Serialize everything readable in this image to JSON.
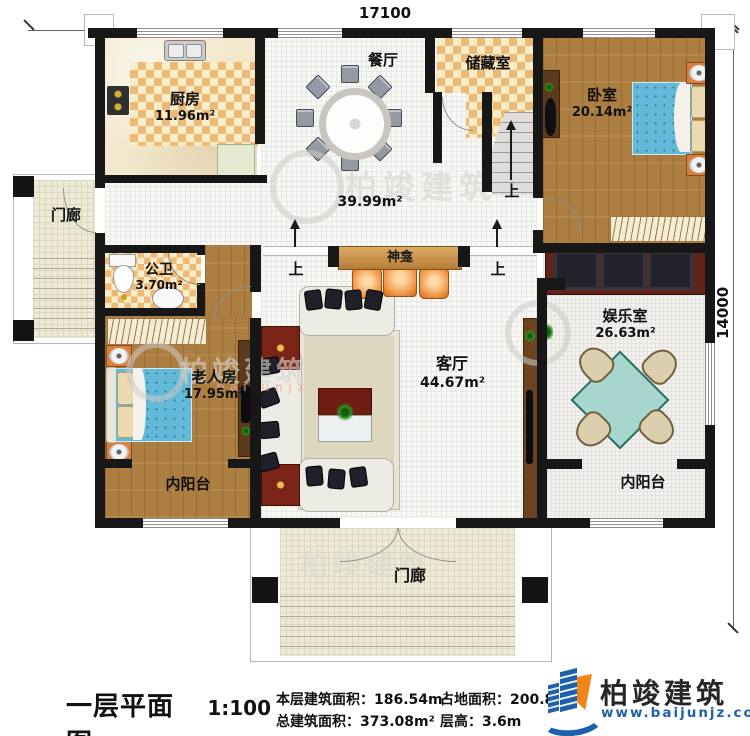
{
  "plan": {
    "dimensions": {
      "top": "17100",
      "right": "14000"
    },
    "up_label": "上",
    "hall_area": "39.99m²",
    "rooms": {
      "kitchen": {
        "name": "厨房",
        "area": "11.96m²"
      },
      "dining": {
        "name": "餐厅"
      },
      "storage": {
        "name": "储藏室"
      },
      "bedroom": {
        "name": "卧室",
        "area": "20.14m²"
      },
      "porch_left": {
        "name": "门廊"
      },
      "bathroom": {
        "name": "公卫",
        "area": "3.70m²"
      },
      "shrine": {
        "name": "神龛"
      },
      "elder_room": {
        "name": "老人房",
        "area": "17.95m²"
      },
      "living_room": {
        "name": "客厅",
        "area": "44.67m²"
      },
      "game_room": {
        "name": "娱乐室",
        "area": "26.63m²"
      },
      "balcony_left": {
        "name": "内阳台"
      },
      "balcony_right": {
        "name": "内阳台"
      },
      "porch_bottom": {
        "name": "门廊"
      }
    }
  },
  "titleblock": {
    "title": "一层平面图",
    "scale": "1:100",
    "floor_area_label": "本层建筑面积：",
    "floor_area_value": "186.54m²",
    "land_area_label": "占地面积：",
    "land_area_value": "200.8",
    "total_area_label": "总建筑面积：",
    "total_area_value": "373.08m²",
    "storey_height_label": "层高：",
    "storey_height_value": "3.6m"
  },
  "logo": {
    "name": "柏竣建筑",
    "website": "www.baijunjz.com"
  },
  "watermark": {
    "text": "柏竣建筑",
    "sub": "baijunjz"
  },
  "colors": {
    "wall": "#171717",
    "brand_blue": "#1e61aa",
    "brand_orange": "#f08519",
    "bed": "#64b9d8",
    "mahjong": "#a6d6ce"
  }
}
